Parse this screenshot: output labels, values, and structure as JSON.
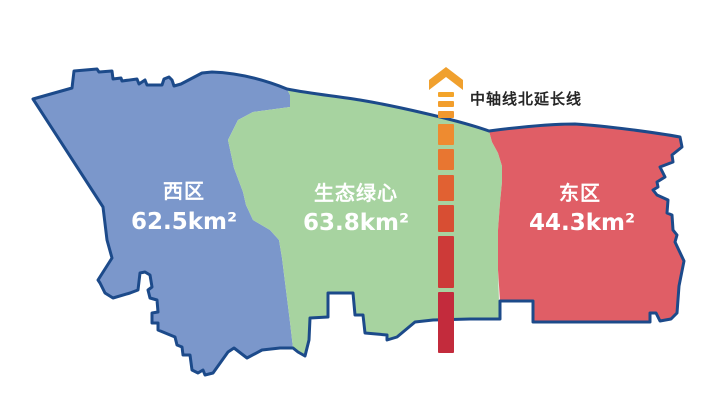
{
  "map": {
    "outline_color": "#1C4A8A",
    "background": "#FFFFFF",
    "label_text_color": "#FFFFFF"
  },
  "regions": {
    "west": {
      "name": "西区",
      "area": "62.5km²",
      "color": "#7B97CB"
    },
    "center": {
      "name": "生态绿心",
      "area": "63.8km²",
      "color": "#A7D3A0"
    },
    "east": {
      "name": "东区",
      "area": "44.3km²",
      "color": "#E05E66"
    }
  },
  "axis": {
    "label": "中轴线北延长线",
    "label_color": "#262626",
    "arrow_color": "#F0A02E",
    "dash_x": 438,
    "dash_width": 16,
    "dashes": [
      {
        "y": 92,
        "h": 5,
        "color": "#F3A42A"
      },
      {
        "y": 101,
        "h": 6,
        "color": "#F29E2C"
      },
      {
        "y": 111,
        "h": 7,
        "color": "#F1982E"
      },
      {
        "y": 124,
        "h": 21,
        "color": "#EE8B30"
      },
      {
        "y": 149,
        "h": 21,
        "color": "#E87631"
      },
      {
        "y": 175,
        "h": 26,
        "color": "#E16132"
      },
      {
        "y": 205,
        "h": 27,
        "color": "#D84E33"
      },
      {
        "y": 236,
        "h": 52,
        "color": "#CD3A38"
      },
      {
        "y": 292,
        "h": 61,
        "color": "#C32B3C"
      }
    ]
  }
}
